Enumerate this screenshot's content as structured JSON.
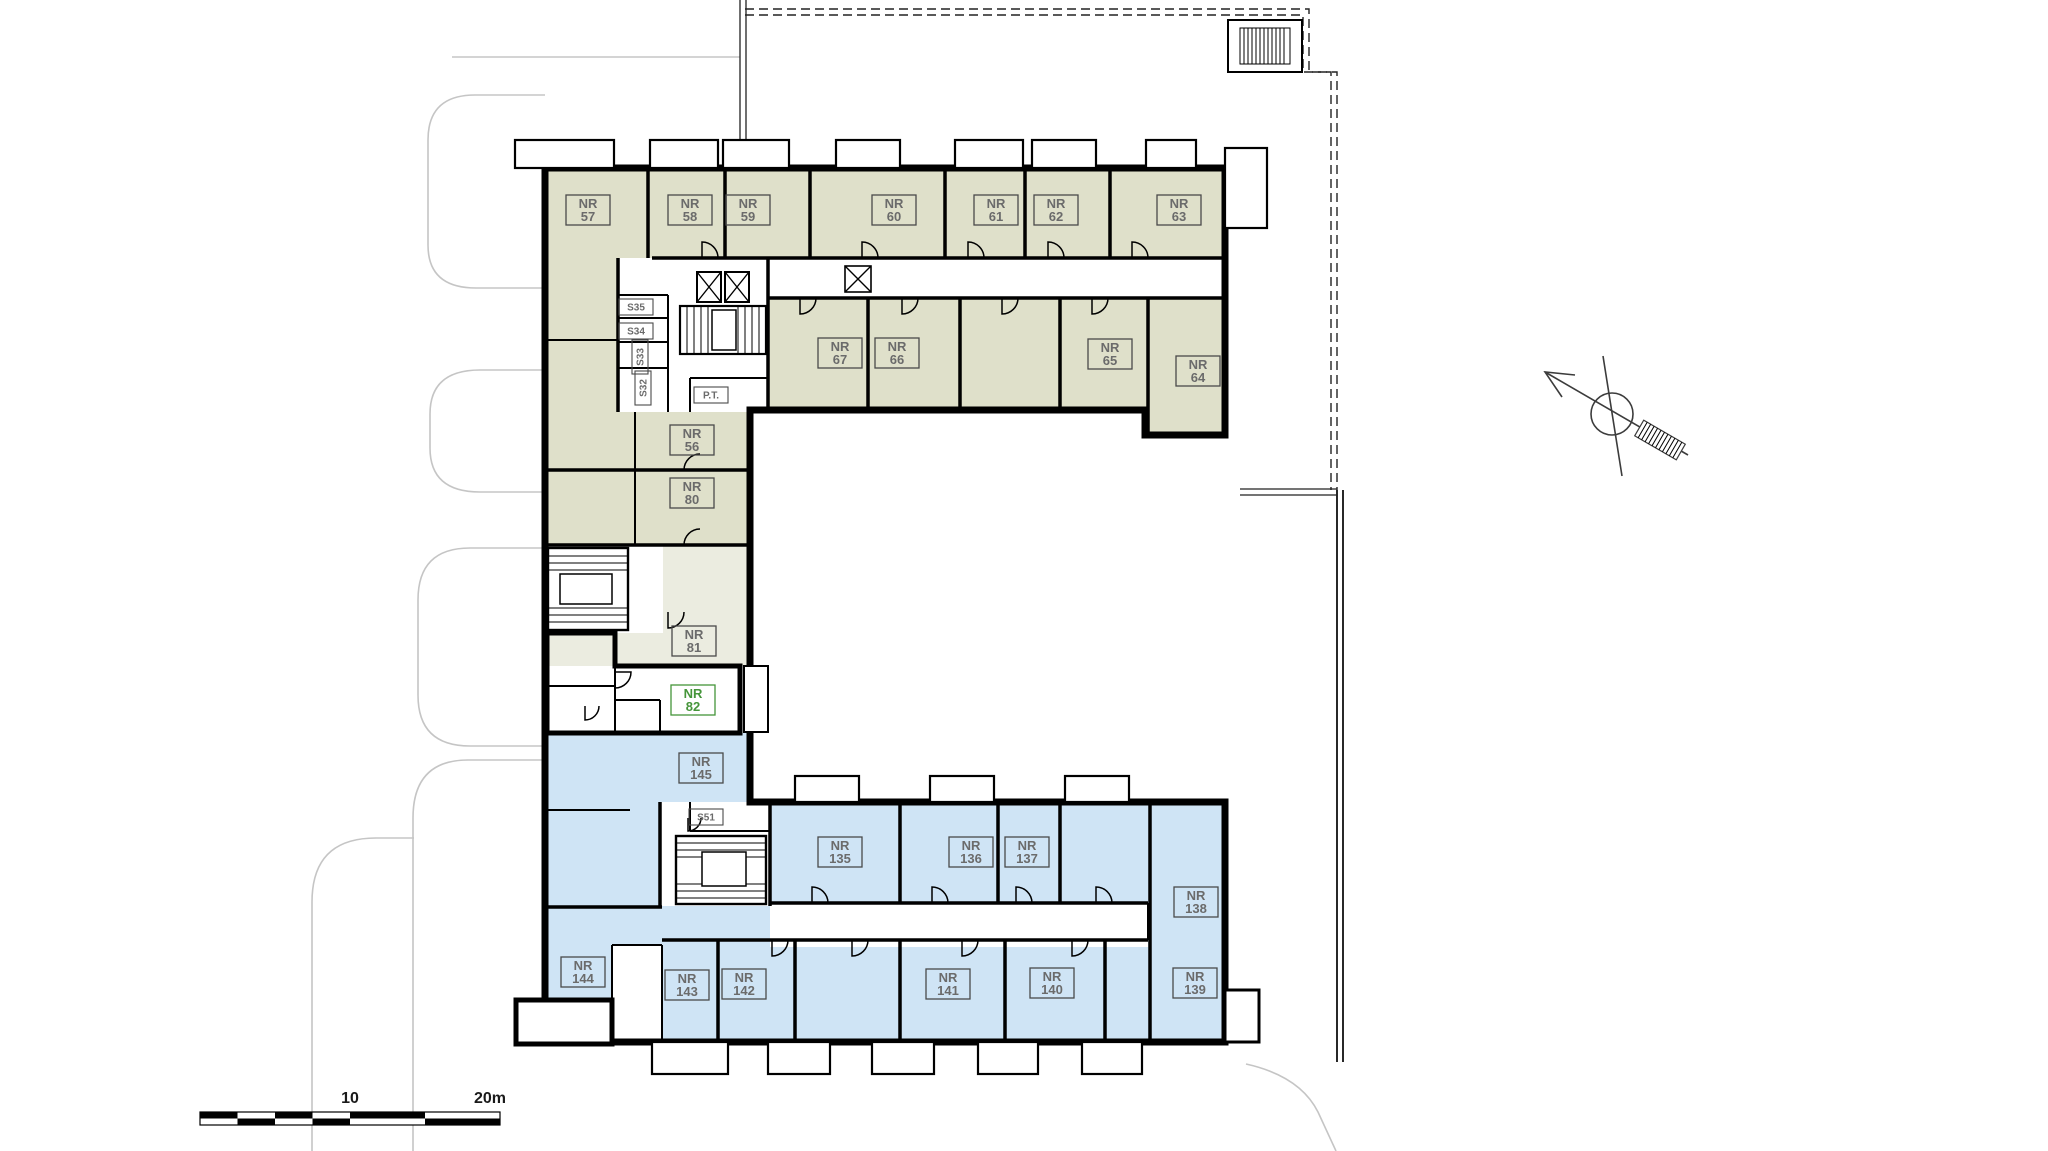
{
  "colors": {
    "unit_olive": "#dfe0ca",
    "unit_olive_light": "#ebece0",
    "unit_blue": "#cfe4f5",
    "highlight_green": "#3ed42d",
    "highlight_label": "#45953a",
    "label_text": "#6b6b6b",
    "label_border": "#4a4a4a",
    "context_gray": "#c5c5c5"
  },
  "highlighted_unit": "NR 82",
  "units": [
    {
      "id": "nr-57",
      "label": "NR 57",
      "x": 588,
      "y": 210,
      "zone": "olive"
    },
    {
      "id": "nr-58",
      "label": "NR 58",
      "x": 690,
      "y": 210,
      "zone": "olive"
    },
    {
      "id": "nr-59",
      "label": "NR 59",
      "x": 748,
      "y": 210,
      "zone": "olive"
    },
    {
      "id": "nr-60",
      "label": "NR 60",
      "x": 894,
      "y": 210,
      "zone": "olive"
    },
    {
      "id": "nr-61",
      "label": "NR 61",
      "x": 996,
      "y": 210,
      "zone": "olive"
    },
    {
      "id": "nr-62",
      "label": "NR 62",
      "x": 1056,
      "y": 210,
      "zone": "olive"
    },
    {
      "id": "nr-63",
      "label": "NR 63",
      "x": 1179,
      "y": 210,
      "zone": "olive"
    },
    {
      "id": "nr-67",
      "label": "NR 67",
      "x": 840,
      "y": 353,
      "zone": "olive"
    },
    {
      "id": "nr-66",
      "label": "NR 66",
      "x": 897,
      "y": 353,
      "zone": "olive"
    },
    {
      "id": "nr-65",
      "label": "NR 65",
      "x": 1110,
      "y": 354,
      "zone": "olive"
    },
    {
      "id": "nr-64",
      "label": "NR 64",
      "x": 1198,
      "y": 371,
      "zone": "olive"
    },
    {
      "id": "nr-56",
      "label": "NR 56",
      "x": 692,
      "y": 440,
      "zone": "olive"
    },
    {
      "id": "nr-80",
      "label": "NR 80",
      "x": 692,
      "y": 493,
      "zone": "olive"
    },
    {
      "id": "nr-81",
      "label": "NR 81",
      "x": 694,
      "y": 641,
      "zone": "olive"
    },
    {
      "id": "nr-82",
      "label": "NR 82",
      "x": 693,
      "y": 700,
      "zone": "green"
    },
    {
      "id": "nr-145",
      "label": "NR 145",
      "x": 701,
      "y": 768,
      "zone": "blue"
    },
    {
      "id": "nr-135",
      "label": "NR 135",
      "x": 840,
      "y": 852,
      "zone": "blue"
    },
    {
      "id": "nr-136",
      "label": "NR 136",
      "x": 971,
      "y": 852,
      "zone": "blue"
    },
    {
      "id": "nr-137",
      "label": "NR 137",
      "x": 1027,
      "y": 852,
      "zone": "blue"
    },
    {
      "id": "nr-138",
      "label": "NR 138",
      "x": 1196,
      "y": 902,
      "zone": "blue"
    },
    {
      "id": "nr-144",
      "label": "NR 144",
      "x": 583,
      "y": 972,
      "zone": "blue"
    },
    {
      "id": "nr-143",
      "label": "NR 143",
      "x": 687,
      "y": 985,
      "zone": "blue"
    },
    {
      "id": "nr-142",
      "label": "NR 142",
      "x": 744,
      "y": 984,
      "zone": "blue"
    },
    {
      "id": "nr-141",
      "label": "NR 141",
      "x": 948,
      "y": 984,
      "zone": "blue"
    },
    {
      "id": "nr-140",
      "label": "NR 140",
      "x": 1052,
      "y": 983,
      "zone": "blue"
    },
    {
      "id": "nr-139",
      "label": "NR 139",
      "x": 1195,
      "y": 983,
      "zone": "blue"
    }
  ],
  "service_labels": [
    {
      "id": "s35",
      "label": "S35",
      "x": 636,
      "y": 307,
      "rot": 0
    },
    {
      "id": "s34",
      "label": "S34",
      "x": 636,
      "y": 331,
      "rot": 0
    },
    {
      "id": "s33",
      "label": "S33",
      "x": 640,
      "y": 357,
      "rot": -90
    },
    {
      "id": "s32",
      "label": "S32",
      "x": 643,
      "y": 388,
      "rot": -90
    },
    {
      "id": "pt",
      "label": "P.T.",
      "x": 711,
      "y": 395,
      "rot": 0
    },
    {
      "id": "s51",
      "label": "S51",
      "x": 706,
      "y": 817,
      "rot": 0
    }
  ],
  "scale_bar": {
    "mid_label": "10",
    "end_label": "20m"
  }
}
